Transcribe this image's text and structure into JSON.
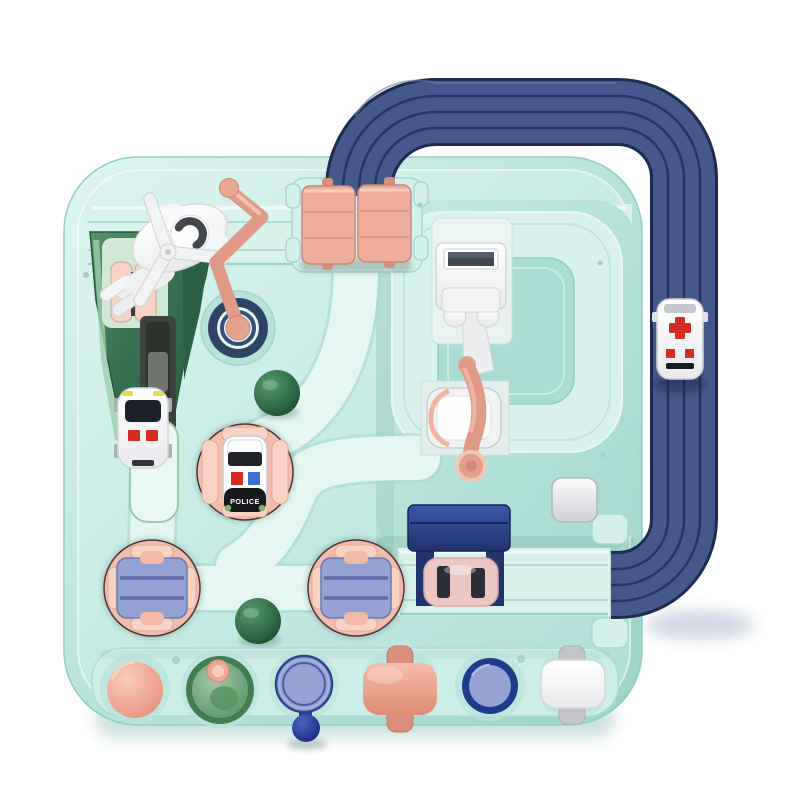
{
  "image": {
    "type": "product-photo",
    "subject": "Children's car adventure rescue track toy playset, top view",
    "visible_text": [
      "POLICE"
    ],
    "background_color": "#ffffff"
  },
  "palette": {
    "board_face": "#c9ece6",
    "board_edge": "#b2e0d8",
    "road": "#d9f2ec",
    "road_bright": "#e4f7f2",
    "road_edge": "#aedcd4",
    "panel_ring": "#d8f3ee",
    "panel_island": "#a9dcd3",
    "track_blue": "#44588b",
    "track_blue_line": "#26355f",
    "track_blue_outline": "#1d2b52",
    "tunnel_roof": "#2f4a97",
    "tunnel_dark": "#22336e",
    "pink": "#efae9c",
    "pink_light": "#f8d2c4",
    "pink_dark": "#d98f7c",
    "salmon": "#df9b87",
    "turntable_pink": "#f3bdae",
    "periwinkle": "#93a2d3",
    "periwinkle_line": "#5d6dab",
    "navy": "#2e4467",
    "navy_ball": "#2b3f9e",
    "green_dark": "#2c6847",
    "green_pale": "#cfe9d4",
    "funnel_rim": "#417e50",
    "ball_green": "#1d5737",
    "red": "#d42b22",
    "police_blue": "#3c6fd1",
    "black": "#17181c",
    "yellow": "#e3d94e",
    "gray": "#c3c5c9",
    "white": "#fafbfb"
  },
  "vehicles": {
    "police_car": {
      "label": "POLICE",
      "body_color": "#ffffff",
      "rear_color": "#17181c"
    },
    "ambulance": {
      "marking": "red-cross",
      "body_color": "#fbfbfc"
    },
    "white_car": {
      "body_color": "#fafafa"
    },
    "pink_car": {
      "body_color": "#ecc6c3"
    },
    "helicopter": {
      "body_color": "#f2f3f4",
      "cockpit_color": "#41464d"
    }
  },
  "controls": [
    {
      "name": "flip-gates",
      "color": "#efae9c"
    },
    {
      "name": "lever-arm",
      "color": "#df9b87"
    },
    {
      "name": "crane-press",
      "color": "#ffffff"
    },
    {
      "name": "turntable-left",
      "platform": "#93a2d3"
    },
    {
      "name": "turntable-right",
      "platform": "#93a2d3"
    },
    {
      "name": "police-turntable",
      "color": "#f3bdae"
    },
    {
      "name": "pink-dome-button",
      "color": "#ec9f8a"
    },
    {
      "name": "green-funnel-button",
      "color": "#6ba478"
    },
    {
      "name": "blue-disc-lever",
      "color": "#93a2d3"
    },
    {
      "name": "pink-cross-roller",
      "color": "#e8a18c"
    },
    {
      "name": "navy-ring-button",
      "color": "#1e3c8c"
    },
    {
      "name": "white-switch-button",
      "color": "#fafbfb"
    }
  ]
}
